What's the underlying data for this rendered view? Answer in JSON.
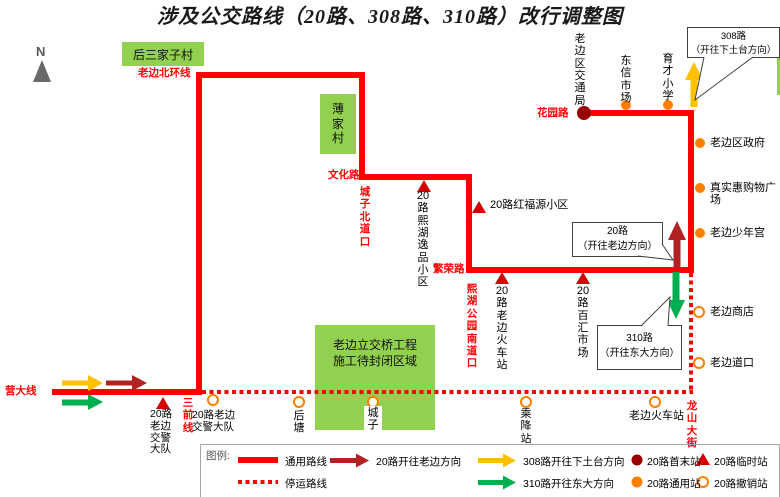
{
  "title": "涉及公交路线（20路、308路、310路）改行调整图",
  "compass_label": "N",
  "areas": {
    "housanjiazi": "后三家子村",
    "bojia": "薄\n家\n村",
    "construction": "老边立交桥工程\n施工待封闭区域"
  },
  "roads": {
    "north_ring": "老边北环线",
    "wenhua": "文化路",
    "chengzi_north": "城\n子\n北\n道\n口",
    "fanrong": "繁荣路",
    "xihu_park_south": "熙\n湖\n公\n园\n南\n道\n口",
    "huayuan": "花园路",
    "yingda": "营大线",
    "sanqian": "三\n前\n线",
    "longshan": "龙\n山\n大\n街"
  },
  "stations": {
    "jiaotongju": "老\n边\n区\n交\n通\n局",
    "dongxin": "东\n信\n市\n场",
    "yucai": "育\n才\n小\n学",
    "qu_zhengfu": "老边区政府",
    "zhenshihui": "真实惠购物广场",
    "shaoniangong": "老边少年宫",
    "shangdian": "老边商店",
    "daokou": "老边道口",
    "xihu_yipin": "20\n路\n熙\n湖\n逸\n品\n小\n区",
    "hongfuyuan": "20路红福源小区",
    "rail_temp": "20\n路\n老\n边\n火\n车\n站",
    "baihui": "20\n路\n百\n汇\n市\n场",
    "jiaojing_temp": "20路\n老边\n交警\n大队",
    "jiaojing_cancelled": "20路老边\n交警大队",
    "houtang": "后\n塘",
    "chengzi": "城\n子",
    "chengjiang": "乘\n降\n站",
    "rail_cancelled": "老边火车站"
  },
  "callouts": {
    "r308": "308路\n（开往下土台方向）",
    "r20": "20路\n（开往老边方向）",
    "r310": "310路\n（开往东大方向）"
  },
  "legend": {
    "heading": "图例:",
    "common_route": "通用路线",
    "suspended_route": "停运路线",
    "r20_direction": "20路开往老边方向",
    "r308_direction": "308路开往下土台方向",
    "r310_direction": "310路开往东大方向",
    "terminus": "20路首末站",
    "temporary": "20路临时站",
    "common_station": "20路通用站",
    "cancelled": "20路撤销站"
  },
  "colors": {
    "route_red": "#FF0000",
    "dark_red_arrow": "#B22222",
    "terminus_dot": "#990000",
    "station_orange": "#FF8000",
    "arrow_yellow": "#FFC000",
    "arrow_green": "#00B050",
    "area_green": "#92D050",
    "road_label_red": "#FF0000"
  }
}
